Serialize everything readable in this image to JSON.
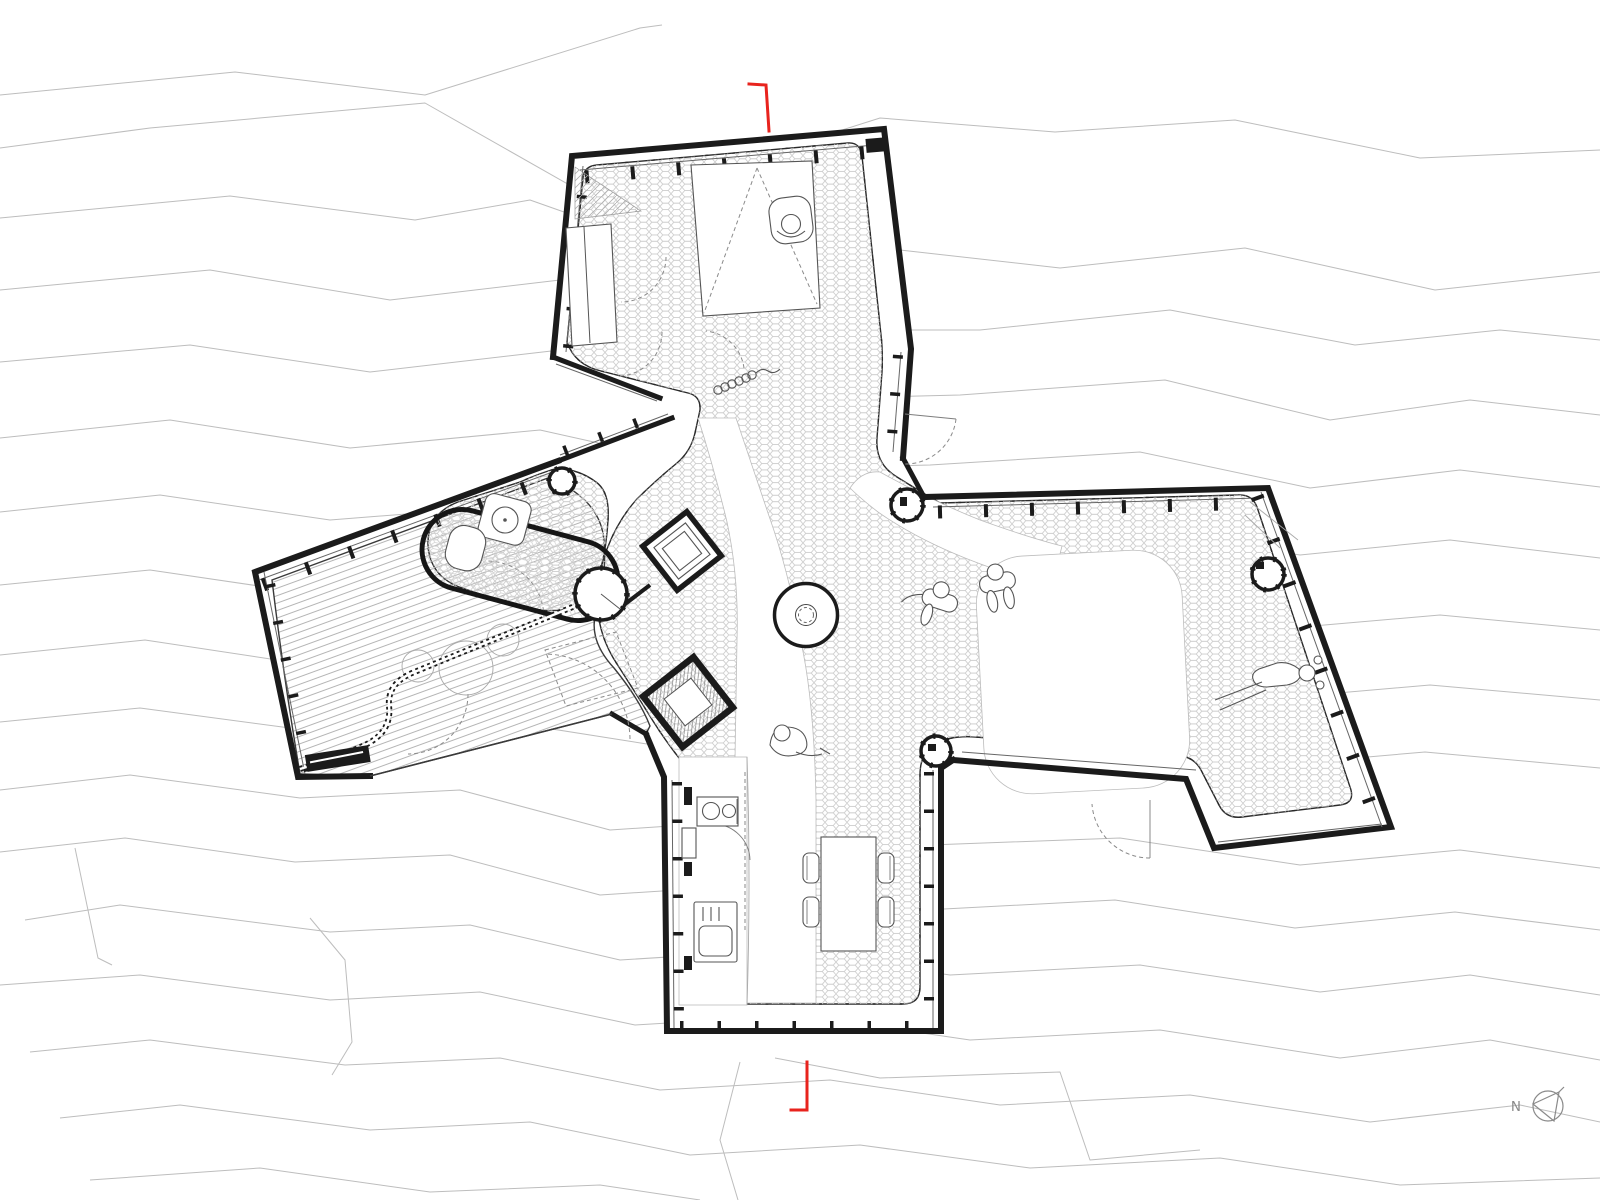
{
  "document": {
    "type": "architectural floor plan",
    "subject": "single-storey cabin with four splayed wings on a sloping site with topographic contour lines",
    "visible_text": [
      "N"
    ]
  },
  "compass": {
    "label": "N"
  },
  "section_markers": {
    "count": 2,
    "positions": [
      "top edge of plan",
      "bottom edge of plan"
    ],
    "color": "#e8231d"
  },
  "patterns": {
    "interior_floor": "hexagonal tiles",
    "terrace": "wood plank decking",
    "site": "topographic contours"
  },
  "colors": {
    "background": "#ffffff",
    "wall": "#1b1b1b",
    "contour": "#bdbdbd",
    "hex_tile": "#cfcfcf",
    "furniture": "#555555",
    "door_arc": "#8a8a8a",
    "section_marker": "#e8231d",
    "north_arrow": "#8a8a8a"
  },
  "features": [
    "north-wing-bedroom",
    "canopy-bed",
    "wardrobe",
    "lounge-chair-figure",
    "doorway-curtain",
    "glazed-corridor",
    "wood-stove",
    "entry-vestibule",
    "round-fire-table",
    "bathroom-pod",
    "wash-basin",
    "bathtub",
    "shower-pod",
    "outdoor-deck",
    "bead-screen",
    "deck-planters",
    "storage-bench",
    "east-wing-living-room",
    "floor-rug",
    "standing-figures",
    "lying-figure",
    "south-wing-kitchen",
    "cooktop",
    "kitchen-sink",
    "dining-table",
    "dining-chairs",
    "seated-floor-figure",
    "door-swing-arcs",
    "section-cut-markers",
    "north-arrow"
  ],
  "figures": {
    "people_count": 5,
    "poses": [
      "seated in armchair",
      "standing",
      "standing",
      "seated on floor",
      "lying down"
    ]
  }
}
